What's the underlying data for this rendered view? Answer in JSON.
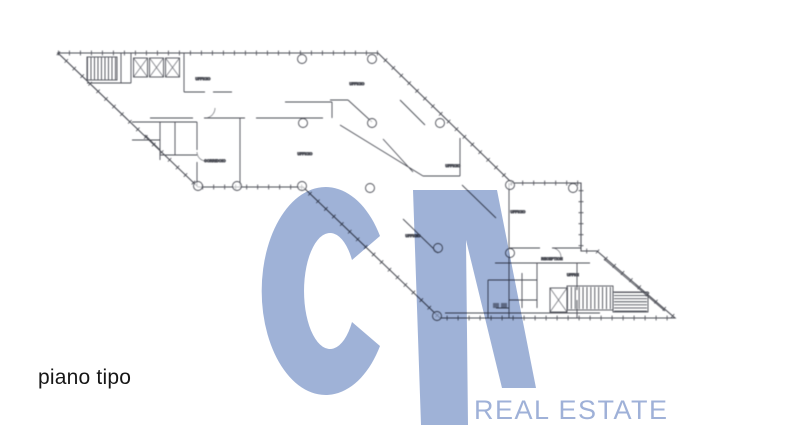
{
  "page": {
    "background_color": "#ffffff"
  },
  "caption": {
    "text": "piano tipo",
    "color": "#161616"
  },
  "watermark": {
    "letters": "CA",
    "color": "#92a7d1",
    "brand_text": "REAL ESTATE",
    "brand_color": "#9fb1d8"
  },
  "floorplan": {
    "line_color": "#4b4d55",
    "room_labels": [
      {
        "text": "UFFICIO",
        "x": 203,
        "y": 80
      },
      {
        "text": "UFFICIO",
        "x": 357,
        "y": 85
      },
      {
        "text": "UFFICIO",
        "x": 305,
        "y": 155
      },
      {
        "text": "CORRIDOIO",
        "x": 215,
        "y": 162
      },
      {
        "text": "UFFICIO",
        "x": 453,
        "y": 167
      },
      {
        "text": "UFFICIO",
        "x": 413,
        "y": 237
      },
      {
        "text": "UFFICIO",
        "x": 518,
        "y": 213
      },
      {
        "text": "RECEPTION",
        "x": 552,
        "y": 260
      },
      {
        "text": "UFFICI",
        "x": 573,
        "y": 276
      }
    ]
  }
}
